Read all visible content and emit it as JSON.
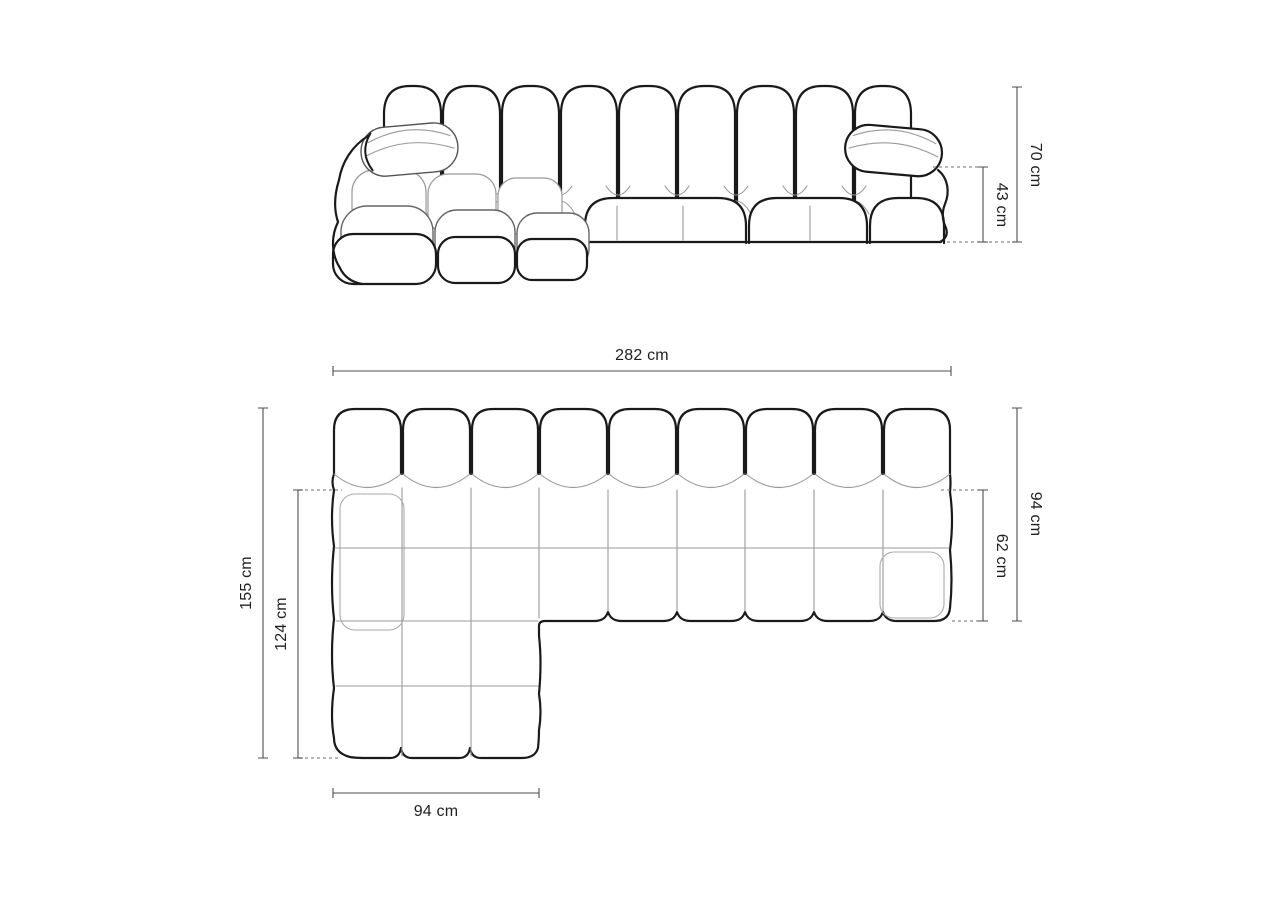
{
  "page": {
    "background": "#ffffff",
    "width": 1280,
    "height": 905
  },
  "style": {
    "outline_bold": "#1a1a1a",
    "outline_thin": "#999999",
    "dimension_line_color": "#4d4d4d",
    "dashed_line_color": "#8a8a8a",
    "label_color": "#1f1f1f"
  },
  "diagram": {
    "unit": "cm",
    "front_view": {
      "dims": {
        "total_height": {
          "label": "70 cm",
          "value": 70
        },
        "seat_height": {
          "label": "43 cm",
          "value": 43
        }
      }
    },
    "top_view": {
      "dims": {
        "total_width": {
          "label": "282 cm",
          "value": 282
        },
        "total_depth_left": {
          "label": "155 cm",
          "value": 155
        },
        "chaise_inner_depth": {
          "label": "124 cm",
          "value": 124
        },
        "right_depth": {
          "label": "94 cm",
          "value": 94
        },
        "right_seat_depth": {
          "label": "62 cm",
          "value": 62
        },
        "chaise_width": {
          "label": "94 cm",
          "value": 94
        }
      }
    }
  }
}
